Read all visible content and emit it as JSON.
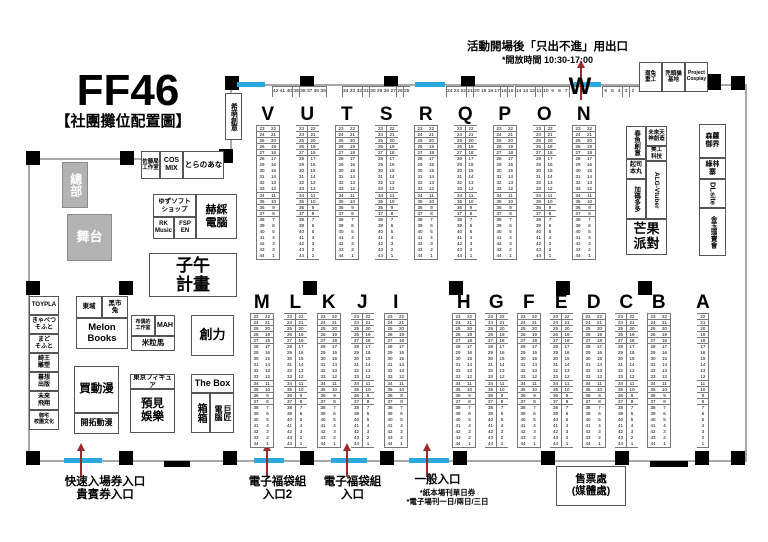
{
  "title": "FF46",
  "subtitle": "【社團攤位配置圖】",
  "top_exit": {
    "line1": "活動開場後「只出不進」用出口",
    "line2": "*開放時間 10:30-17:00"
  },
  "w_section": {
    "letter": "W",
    "groups": [
      [
        42,
        41,
        40,
        39,
        38,
        37,
        36,
        35
      ],
      [
        34,
        33,
        32,
        31,
        30,
        29,
        28,
        27,
        26,
        25
      ],
      [
        24,
        23,
        22,
        21,
        20,
        19,
        18,
        17,
        16,
        15
      ],
      [
        14,
        13,
        12,
        11,
        10,
        9,
        8,
        7
      ],
      [
        6,
        5,
        4,
        3,
        2,
        1
      ]
    ]
  },
  "booth_numbers": {
    "left": [
      23,
      24,
      25,
      26,
      27,
      28,
      29,
      30,
      31,
      32,
      33,
      34,
      35,
      36,
      37,
      38,
      39,
      40,
      41,
      42,
      43,
      44
    ],
    "right": [
      22,
      21,
      20,
      19,
      18,
      17,
      16,
      15,
      14,
      13,
      12,
      11,
      10,
      9,
      8,
      7,
      6,
      5,
      4,
      3,
      2,
      1
    ],
    "single": [
      22,
      21,
      20,
      19,
      18,
      17,
      16,
      15,
      14,
      13,
      12,
      11,
      10,
      9,
      8,
      7,
      6,
      5,
      4,
      3,
      2,
      1
    ]
  },
  "sections": [
    {
      "id": "top",
      "letters": [
        "V",
        "U",
        "T",
        "S",
        "R",
        "Q",
        "P",
        "O",
        "N"
      ]
    },
    {
      "id": "bottom-left",
      "letters": [
        "M",
        "L",
        "K",
        "J",
        "I"
      ]
    },
    {
      "id": "bottom-right",
      "letters": [
        "H",
        "G",
        "F",
        "E",
        "D",
        "C",
        "B"
      ]
    },
    {
      "id": "col-a",
      "letters": [
        "A"
      ],
      "single": true
    }
  ],
  "landmarks": {
    "hq": "總部",
    "stage": "舞台",
    "simmore": "希萌創意",
    "sato": "佐藤局\n工作室",
    "cosmix": "COS\nMIX",
    "toranoana": "とらのあな",
    "yuzusoft": "ゆずソフト\nショップ",
    "rk": "RK\nMusic",
    "fsp": "FSP\nEN",
    "hech": "赫綵\n電腦",
    "ziwu": "子午\n計畫",
    "left_stack": [
      "TOYPLA",
      "きゃべつ\nそふと",
      "まど\nそふと",
      "綺王\n雕塑",
      "暮想\n出版",
      "未來\n飛翔",
      "御宅\n校園文化"
    ],
    "dongyu": "東域",
    "blackbunny": "黑市\n兔",
    "melon": "Melon\nBooks",
    "mycomic": "買動漫",
    "kaitaku": "開拓動漫",
    "puppet": "布偶的\n工作室",
    "mah": "MAH",
    "milima": "米粒馬",
    "chuangli": "創力",
    "tokyofigure": "東京フィギュア",
    "yujian": "預見\n娛樂",
    "thebox": "The Box",
    "boxbox": "箱箱",
    "gjun": "巨匠\n電腦",
    "springfish": "春魚創意",
    "futuretenjin": "未來天\n神創造",
    "meigong": "美工\n科技",
    "cheese": "起司\n本丸",
    "alg": "ALG-Vtuber",
    "jiama": "加碼多多",
    "mango": "芒果\n派對",
    "senluo": "森蘿\n御界",
    "lvlin": "綠林\n寨",
    "dlsite": "DLsite",
    "jinyu": "金玉環寶會",
    "rabbit": "遛兔\n重工",
    "baldcat": "禿頭貓\n基地",
    "project": "Project\nCosplay"
  },
  "entrances": {
    "fast": "快速入場券入口\n貴賓券入口",
    "ebag2": "電子福袋組\n入口2",
    "ebag": "電子福袋組\n入口",
    "general": "一般入口",
    "general_note1": "*紙本場刊單日券",
    "general_note2": "*電子場刊一日/兩日/三日",
    "ticket": "售票處\n(媒體處)"
  },
  "colors": {
    "entrance_blue": "#2BA8E0",
    "arrow_red": "#9B2B2B",
    "pillar_black": "#000000",
    "gray_box": "#B3B3B3",
    "wall_gray": "#A9A9A9"
  }
}
